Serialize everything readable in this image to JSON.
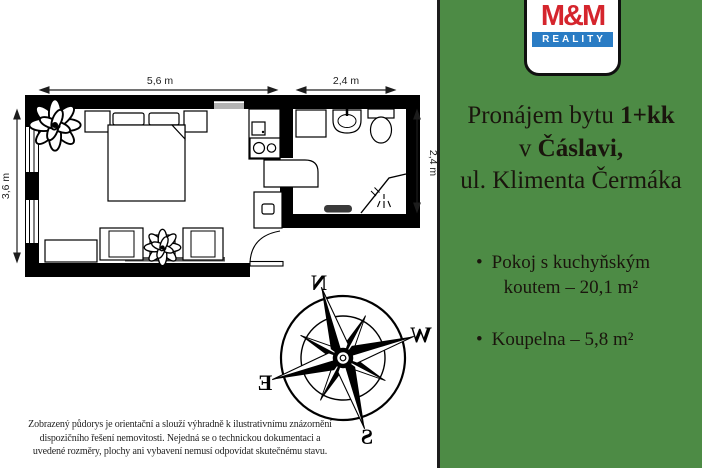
{
  "brand": {
    "logo_mm": "M&M",
    "logo_reality": "REALITY",
    "logo_red": "#d5252d",
    "logo_blue": "#2a7cc4"
  },
  "listing": {
    "background_green": "#4d8b45",
    "title_line1_regular": "Pronájem bytu ",
    "title_line1_bold": "1+kk",
    "title_line2_regular": "v ",
    "title_line2_bold": "Čáslavi,",
    "title_line3": "ul. Klimenta Čermáka",
    "bullets": [
      {
        "line1": "Pokoj s kuchyňským",
        "line2": "koutem – 20,1 m²"
      },
      {
        "line1": "Koupelna – 5,8 m²",
        "line2": ""
      }
    ]
  },
  "floorplan": {
    "dim_top_main": "5,6 m",
    "dim_top_bath": "2,4 m",
    "dim_left": "3,6 m",
    "dim_right": "2,4 m"
  },
  "compass": {
    "n": "N",
    "e": "E",
    "s": "S",
    "w": "W"
  },
  "disclaimer_lines": [
    "Zobrazený půdorys je orientační a slouží výhradně k ilustrativnímu znázornění",
    "dispozičního řešení nemovitosti. Nejedná se o technickou dokumentaci a",
    "uvedené rozměry, plochy ani vybavení nemusí odpovídat skutečnému stavu."
  ]
}
